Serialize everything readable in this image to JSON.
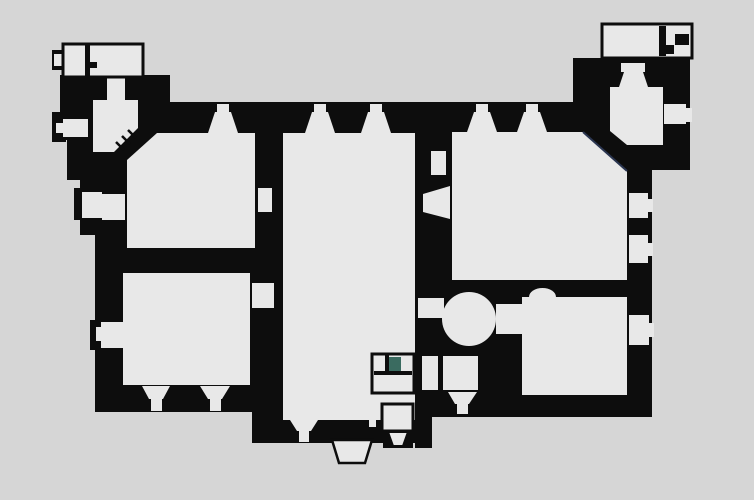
{
  "canvas": {
    "width": 754,
    "height": 500
  },
  "colors": {
    "background": "#d6d6d6",
    "wall": "#0d0d0d",
    "room": "#e8e8e8",
    "outline": "#0d0d0d",
    "stair_accent": "#3a6b60",
    "chamfer_accent": "#2a3550",
    "none": "none"
  },
  "floorplan": {
    "type": "castle-floor-plan",
    "walls": [
      {
        "n": "upper-left-block",
        "t": "r",
        "x": 60,
        "y": 75,
        "w": 110,
        "h": 35
      },
      {
        "n": "west-wall-top",
        "t": "r",
        "x": 60,
        "y": 75,
        "w": 55,
        "h": 65
      },
      {
        "n": "west-wall-step1",
        "t": "r",
        "x": 67,
        "y": 140,
        "w": 48,
        "h": 40
      },
      {
        "n": "west-wall-step2",
        "t": "r",
        "x": 80,
        "y": 178,
        "w": 47,
        "h": 57
      },
      {
        "n": "west-wall-lower",
        "t": "r",
        "x": 95,
        "y": 235,
        "w": 32,
        "h": 177
      },
      {
        "n": "north-band",
        "t": "r",
        "x": 95,
        "y": 102,
        "w": 478,
        "h": 31
      },
      {
        "n": "left-wing-core",
        "t": "r",
        "x": 95,
        "y": 102,
        "w": 188,
        "h": 310
      },
      {
        "n": "south-wall",
        "t": "r",
        "x": 252,
        "y": 412,
        "w": 168,
        "h": 31
      },
      {
        "n": "center-column-west",
        "t": "r",
        "x": 415,
        "y": 102,
        "w": 17,
        "h": 346
      },
      {
        "n": "center-column-east",
        "t": "r",
        "x": 432,
        "y": 102,
        "w": 20,
        "h": 315
      },
      {
        "n": "right-wing-core",
        "t": "r",
        "x": 452,
        "y": 102,
        "w": 175,
        "h": 315
      },
      {
        "n": "ne-tower-block",
        "t": "r",
        "x": 573,
        "y": 58,
        "w": 117,
        "h": 112
      },
      {
        "n": "east-wall",
        "t": "r",
        "x": 627,
        "y": 170,
        "w": 25,
        "h": 247
      },
      {
        "n": "hall-se-block",
        "t": "r",
        "x": 356,
        "y": 336,
        "w": 59,
        "h": 84
      },
      {
        "n": "west-bump-1",
        "t": "r",
        "x": 52,
        "y": 112,
        "w": 14,
        "h": 30
      },
      {
        "n": "west-bump-2",
        "t": "r",
        "x": 74,
        "y": 188,
        "w": 10,
        "h": 32
      },
      {
        "n": "west-bump-3",
        "t": "r",
        "x": 90,
        "y": 320,
        "w": 8,
        "h": 30
      },
      {
        "n": "entrance-steps-base",
        "t": "r",
        "x": 383,
        "y": 428,
        "w": 30,
        "h": 20
      },
      {
        "n": "outbuilding-tl-tick",
        "t": "r",
        "x": 52,
        "y": 50,
        "w": 12,
        "h": 20
      }
    ],
    "rooms": [
      {
        "n": "outbuilding-tl-slit",
        "t": "r",
        "x": 54,
        "y": 54,
        "w": 8,
        "h": 12,
        "f": "room"
      },
      {
        "n": "door-outbuilding-to-tower",
        "t": "r",
        "x": 107,
        "y": 77,
        "w": 18,
        "h": 25,
        "f": "room"
      },
      {
        "n": "tower-room-nw",
        "t": "p",
        "pts": "93,100 138,100 138,128 114,152 93,152",
        "f": "room"
      },
      {
        "n": "west-window-1",
        "t": "r",
        "x": 63,
        "y": 119,
        "w": 25,
        "h": 18,
        "f": "room"
      },
      {
        "n": "west-window-1-slit",
        "t": "r",
        "x": 56,
        "y": 123,
        "w": 8,
        "h": 10,
        "f": "room"
      },
      {
        "n": "room-a-nw",
        "t": "p",
        "pts": "127,160 157,133 255,133 255,248 127,248",
        "f": "room"
      },
      {
        "n": "west-window-2",
        "t": "r",
        "x": 82,
        "y": 192,
        "w": 20,
        "h": 26,
        "f": "room"
      },
      {
        "n": "west-window-2-splay",
        "t": "r",
        "x": 102,
        "y": 194,
        "w": 23,
        "h": 26,
        "f": "room"
      },
      {
        "n": "door-room-a-east",
        "t": "r",
        "x": 258,
        "y": 188,
        "w": 14,
        "h": 24,
        "f": "room"
      },
      {
        "n": "room-b-sw",
        "t": "r",
        "x": 123,
        "y": 273,
        "w": 127,
        "h": 112,
        "f": "room"
      },
      {
        "n": "west-window-3",
        "t": "r",
        "x": 101,
        "y": 322,
        "w": 22,
        "h": 26,
        "f": "room"
      },
      {
        "n": "west-window-3-slit",
        "t": "r",
        "x": 96,
        "y": 327,
        "w": 5,
        "h": 14,
        "f": "room"
      },
      {
        "n": "door-room-b-east",
        "t": "r",
        "x": 252,
        "y": 283,
        "w": 22,
        "h": 25,
        "f": "room"
      },
      {
        "n": "south-window-1",
        "t": "p",
        "pts": "142,386 170,386 163,399 149,399",
        "f": "room"
      },
      {
        "n": "south-window-1-slit",
        "t": "r",
        "x": 151,
        "y": 399,
        "w": 11,
        "h": 12,
        "f": "room"
      },
      {
        "n": "south-window-2",
        "t": "p",
        "pts": "200,386 230,386 222,399 208,399",
        "f": "room"
      },
      {
        "n": "south-window-2-slit",
        "t": "r",
        "x": 210,
        "y": 399,
        "w": 11,
        "h": 12,
        "f": "room"
      },
      {
        "n": "great-hall",
        "t": "r",
        "x": 283,
        "y": 133,
        "w": 132,
        "h": 287,
        "f": "room"
      },
      {
        "n": "hall-south-window",
        "t": "p",
        "pts": "290,420 318,420 311,431 297,431",
        "f": "room"
      },
      {
        "n": "hall-south-window-slit",
        "t": "r",
        "x": 299,
        "y": 431,
        "w": 10,
        "h": 11,
        "f": "room"
      },
      {
        "n": "north-embrasure-1-slit",
        "t": "r",
        "x": 217,
        "y": 104,
        "w": 12,
        "h": 8,
        "f": "room"
      },
      {
        "n": "north-embrasure-1",
        "t": "p",
        "pts": "215,112 231,112 238,133 208,133",
        "f": "room"
      },
      {
        "n": "north-embrasure-2-slit",
        "t": "r",
        "x": 314,
        "y": 104,
        "w": 12,
        "h": 8,
        "f": "room"
      },
      {
        "n": "north-embrasure-2",
        "t": "p",
        "pts": "312,112 328,112 335,133 305,133",
        "f": "room"
      },
      {
        "n": "north-embrasure-3-slit",
        "t": "r",
        "x": 370,
        "y": 104,
        "w": 12,
        "h": 8,
        "f": "room"
      },
      {
        "n": "north-embrasure-3",
        "t": "p",
        "pts": "368,112 384,112 391,133 361,133",
        "f": "room"
      },
      {
        "n": "north-embrasure-4-slit",
        "t": "r",
        "x": 476,
        "y": 104,
        "w": 12,
        "h": 8,
        "f": "room"
      },
      {
        "n": "north-embrasure-4",
        "t": "p",
        "pts": "474,112 490,112 497,132 467,132",
        "f": "room"
      },
      {
        "n": "north-embrasure-5-slit",
        "t": "r",
        "x": 526,
        "y": 104,
        "w": 12,
        "h": 8,
        "f": "room"
      },
      {
        "n": "north-embrasure-5",
        "t": "p",
        "pts": "524,112 540,112 547,132 517,132",
        "f": "room"
      },
      {
        "n": "wall-niche-east-of-hall",
        "t": "r",
        "x": 431,
        "y": 151,
        "w": 15,
        "h": 24,
        "f": "room"
      },
      {
        "n": "embrasure-hall-east",
        "t": "p",
        "pts": "423,194 450,186 450,219 423,212",
        "f": "room"
      },
      {
        "n": "state-room-ne",
        "t": "p",
        "pts": "452,132 583,132 627,171 627,280 452,280",
        "f": "room"
      },
      {
        "n": "ne-embrasure-slit",
        "t": "r",
        "x": 621,
        "y": 63,
        "w": 24,
        "h": 9,
        "f": "room"
      },
      {
        "n": "ne-embrasure",
        "t": "p",
        "pts": "624,72 643,72 648,87 619,87",
        "f": "room"
      },
      {
        "n": "ne-tower-room",
        "t": "p",
        "pts": "610,87 663,87 663,145 627,145 610,131",
        "f": "room"
      },
      {
        "n": "ne-east-window",
        "t": "r",
        "x": 664,
        "y": 104,
        "w": 22,
        "h": 20,
        "f": "room"
      },
      {
        "n": "ne-east-window-slit",
        "t": "r",
        "x": 686,
        "y": 108,
        "w": 6,
        "h": 14,
        "f": "room"
      },
      {
        "n": "east-window-1",
        "t": "r",
        "x": 629,
        "y": 193,
        "w": 19,
        "h": 25,
        "f": "room"
      },
      {
        "n": "east-window-1-slit",
        "t": "r",
        "x": 648,
        "y": 199,
        "w": 5,
        "h": 13,
        "f": "room"
      },
      {
        "n": "east-window-2",
        "t": "r",
        "x": 629,
        "y": 235,
        "w": 19,
        "h": 28,
        "f": "room"
      },
      {
        "n": "east-window-2-slit",
        "t": "r",
        "x": 648,
        "y": 243,
        "w": 5,
        "h": 13,
        "f": "room"
      },
      {
        "n": "east-window-3",
        "t": "r",
        "x": 629,
        "y": 315,
        "w": 20,
        "h": 30,
        "f": "room"
      },
      {
        "n": "east-window-3-slit",
        "t": "r",
        "x": 649,
        "y": 323,
        "w": 5,
        "h": 14,
        "f": "room"
      },
      {
        "n": "round-chamber",
        "t": "c",
        "cx": 469,
        "cy": 319,
        "r": 27,
        "f": "room"
      },
      {
        "n": "passage-west-of-round",
        "t": "r",
        "x": 418,
        "y": 298,
        "w": 26,
        "h": 20,
        "f": "room"
      },
      {
        "n": "passage-east-of-round",
        "t": "r",
        "x": 496,
        "y": 304,
        "w": 26,
        "h": 30,
        "f": "room"
      },
      {
        "n": "room-se",
        "t": "r",
        "x": 522,
        "y": 297,
        "w": 105,
        "h": 98,
        "f": "room"
      },
      {
        "n": "room-se-north-notch",
        "t": "d",
        "d": "M529,297 A13.5,9 0 0 1 556,297 Z",
        "f": "room"
      },
      {
        "n": "closet-south-1",
        "t": "r",
        "x": 422,
        "y": 356,
        "w": 16,
        "h": 34,
        "f": "room"
      },
      {
        "n": "closet-south-2",
        "t": "r",
        "x": 443,
        "y": 356,
        "w": 35,
        "h": 34,
        "f": "room"
      },
      {
        "n": "south-window-3",
        "t": "p",
        "pts": "448,392 477,392 469,404 455,404",
        "f": "room"
      },
      {
        "n": "south-window-3-slit",
        "t": "r",
        "x": 457,
        "y": 404,
        "w": 11,
        "h": 10,
        "f": "room"
      },
      {
        "n": "entrance-sliver",
        "t": "r",
        "x": 369,
        "y": 407,
        "w": 7,
        "h": 20,
        "f": "room"
      }
    ],
    "outlined": [
      {
        "n": "outbuilding-top-left",
        "t": "r",
        "x": 63,
        "y": 44,
        "w": 80,
        "h": 33,
        "f": "room",
        "sc": "outline",
        "sw": 3
      },
      {
        "n": "outbuilding-north-east",
        "t": "r",
        "x": 602,
        "y": 24,
        "w": 90,
        "h": 34,
        "f": "room",
        "sc": "outline",
        "sw": 3
      },
      {
        "n": "stair-room",
        "t": "r",
        "x": 372,
        "y": 354,
        "w": 42,
        "h": 39,
        "f": "room",
        "sc": "outline",
        "sw": 3
      },
      {
        "n": "entrance-vestibule",
        "t": "r",
        "x": 382,
        "y": 404,
        "w": 31,
        "h": 27,
        "f": "room",
        "sc": "outline",
        "sw": 3
      },
      {
        "n": "entrance-porch-steps",
        "t": "p",
        "pts": "332,440 372,440 365,463 339,463",
        "f": "room",
        "sc": "outline",
        "sw": 2.5
      },
      {
        "n": "vestibule-steps",
        "t": "p",
        "pts": "388,432 408,432 403,446 393,446",
        "f": "room",
        "sc": "outline",
        "sw": 2
      }
    ],
    "details": [
      {
        "n": "stair-accent-cell",
        "t": "r",
        "x": 388,
        "y": 357,
        "w": 13,
        "h": 14,
        "f": "stair_accent"
      },
      {
        "n": "stair-room-partition-v",
        "t": "r",
        "x": 385,
        "y": 354,
        "w": 4,
        "h": 18,
        "f": "wall"
      },
      {
        "n": "stair-room-partition-h",
        "t": "r",
        "x": 374,
        "y": 371,
        "w": 38,
        "h": 4,
        "f": "wall"
      },
      {
        "n": "outbuilding-tl-partition",
        "t": "r",
        "x": 85,
        "y": 44,
        "w": 5,
        "h": 33,
        "f": "wall"
      },
      {
        "n": "outbuilding-tl-door-tick",
        "t": "r",
        "x": 90,
        "y": 62,
        "w": 7,
        "h": 6,
        "f": "wall"
      },
      {
        "n": "outbuilding-ne-partition",
        "t": "r",
        "x": 659,
        "y": 26,
        "w": 7,
        "h": 30,
        "f": "wall"
      },
      {
        "n": "outbuilding-ne-stair-tick-1",
        "t": "r",
        "x": 675,
        "y": 34,
        "w": 14,
        "h": 11,
        "f": "wall"
      },
      {
        "n": "outbuilding-ne-stair-tick-2",
        "t": "r",
        "x": 665,
        "y": 45,
        "w": 9,
        "h": 9,
        "f": "wall"
      },
      {
        "n": "tower-stair-treads",
        "t": "d",
        "d": "M116,142 L124,150 M122,136 L130,144 M128,130 L136,138",
        "f": "none",
        "sc": "wall",
        "sw": 2.5
      },
      {
        "n": "state-room-chamfer-line",
        "t": "d",
        "d": "M583,132 L627,171",
        "f": "none",
        "sc": "chamfer_accent",
        "sw": 2
      }
    ]
  }
}
